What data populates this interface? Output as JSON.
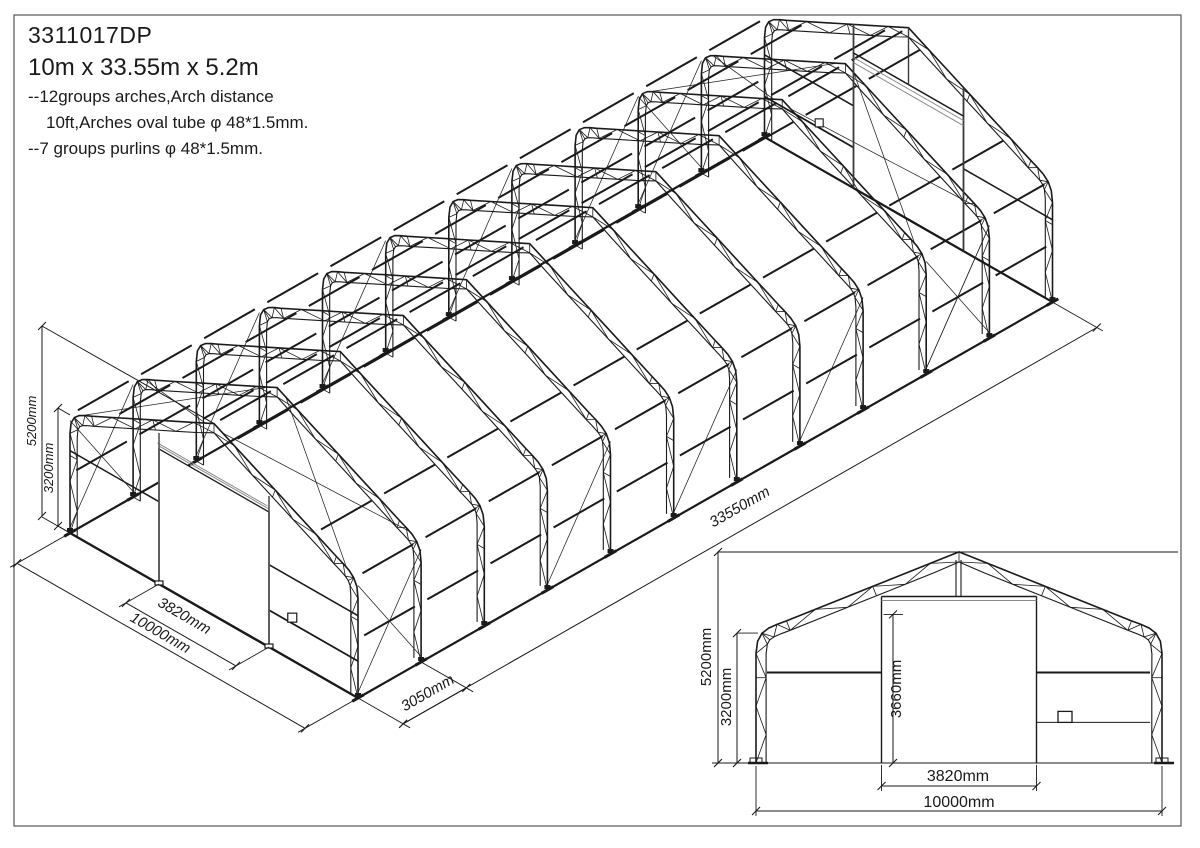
{
  "title_block": {
    "model_no": "3311017DP",
    "overall_size": "10m x 33.55m x 5.2m",
    "note_arches_1": "--12groups arches,Arch distance",
    "note_arches_2": "10ft,Arches oval tube  φ 48*1.5mm.",
    "note_purlins": "--7 groups purlins  φ 48*1.5mm."
  },
  "model": {
    "arch_count": 12,
    "bay_mm": 3050,
    "width_mm": 10000,
    "length_mm": 33550,
    "ridge_height_mm": 5200,
    "eave_height_mm": 3200,
    "door_width_mm": 3820,
    "door_height_mm": 3660
  },
  "iso_dims": {
    "total_height": "5200mm",
    "eave_height": "3200mm",
    "door_width": "3820mm",
    "total_width": "10000mm",
    "bay_spacing": "3050mm",
    "total_length": "33550mm"
  },
  "elev_dims": {
    "total_height": "5200mm",
    "eave_height": "3200mm",
    "door_height": "3660mm",
    "door_width": "3820mm",
    "total_width": "10000mm"
  },
  "colors": {
    "ink": "#1a1a1a",
    "track_gray": "#8a8a8a",
    "border_gray": "#555555"
  }
}
